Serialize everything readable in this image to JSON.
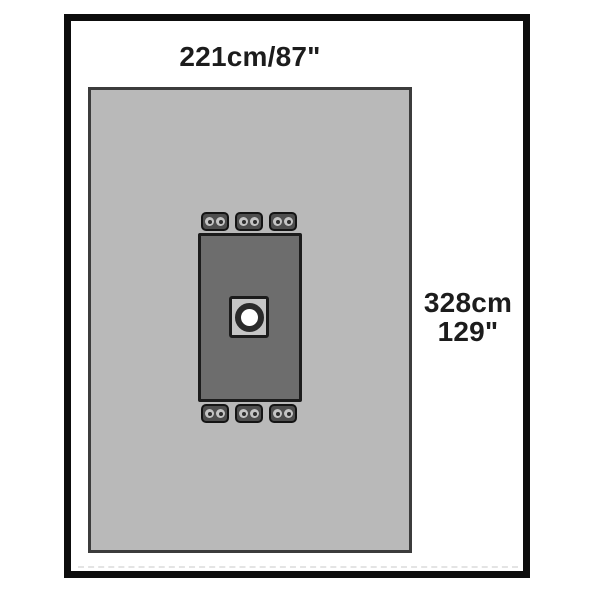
{
  "image": {
    "type": "product-diagram",
    "subject": "surgical drape with fenestration and fastening tabs",
    "dimension_labels": {
      "width": "221cm/87\"",
      "height_cm": "328cm",
      "height_in": "129\""
    },
    "fastener_tabs": {
      "top_count": 3,
      "bottom_count": 3,
      "grommets_per_tab": 2
    },
    "colors": {
      "frame_border": "#0d0d0d",
      "drape_fill": "#b9b9b9",
      "drape_border": "#3c3c3c",
      "inner_fill": "#6d6d6d",
      "inner_border": "#1c1c1c",
      "tab_fill": "#4e4e4e",
      "tab_border": "#141414",
      "grommet_fill": "#c4c4c4",
      "grommet_dot": "#2e2e2e",
      "pad_fill": "#c6c6c6",
      "pad_border": "#1c1c1c",
      "hole_ring": "#2b2b2b",
      "hole_fill": "#ffffff",
      "label_text": "#1c1c1c",
      "fold_line": "#e4e4e4"
    }
  }
}
